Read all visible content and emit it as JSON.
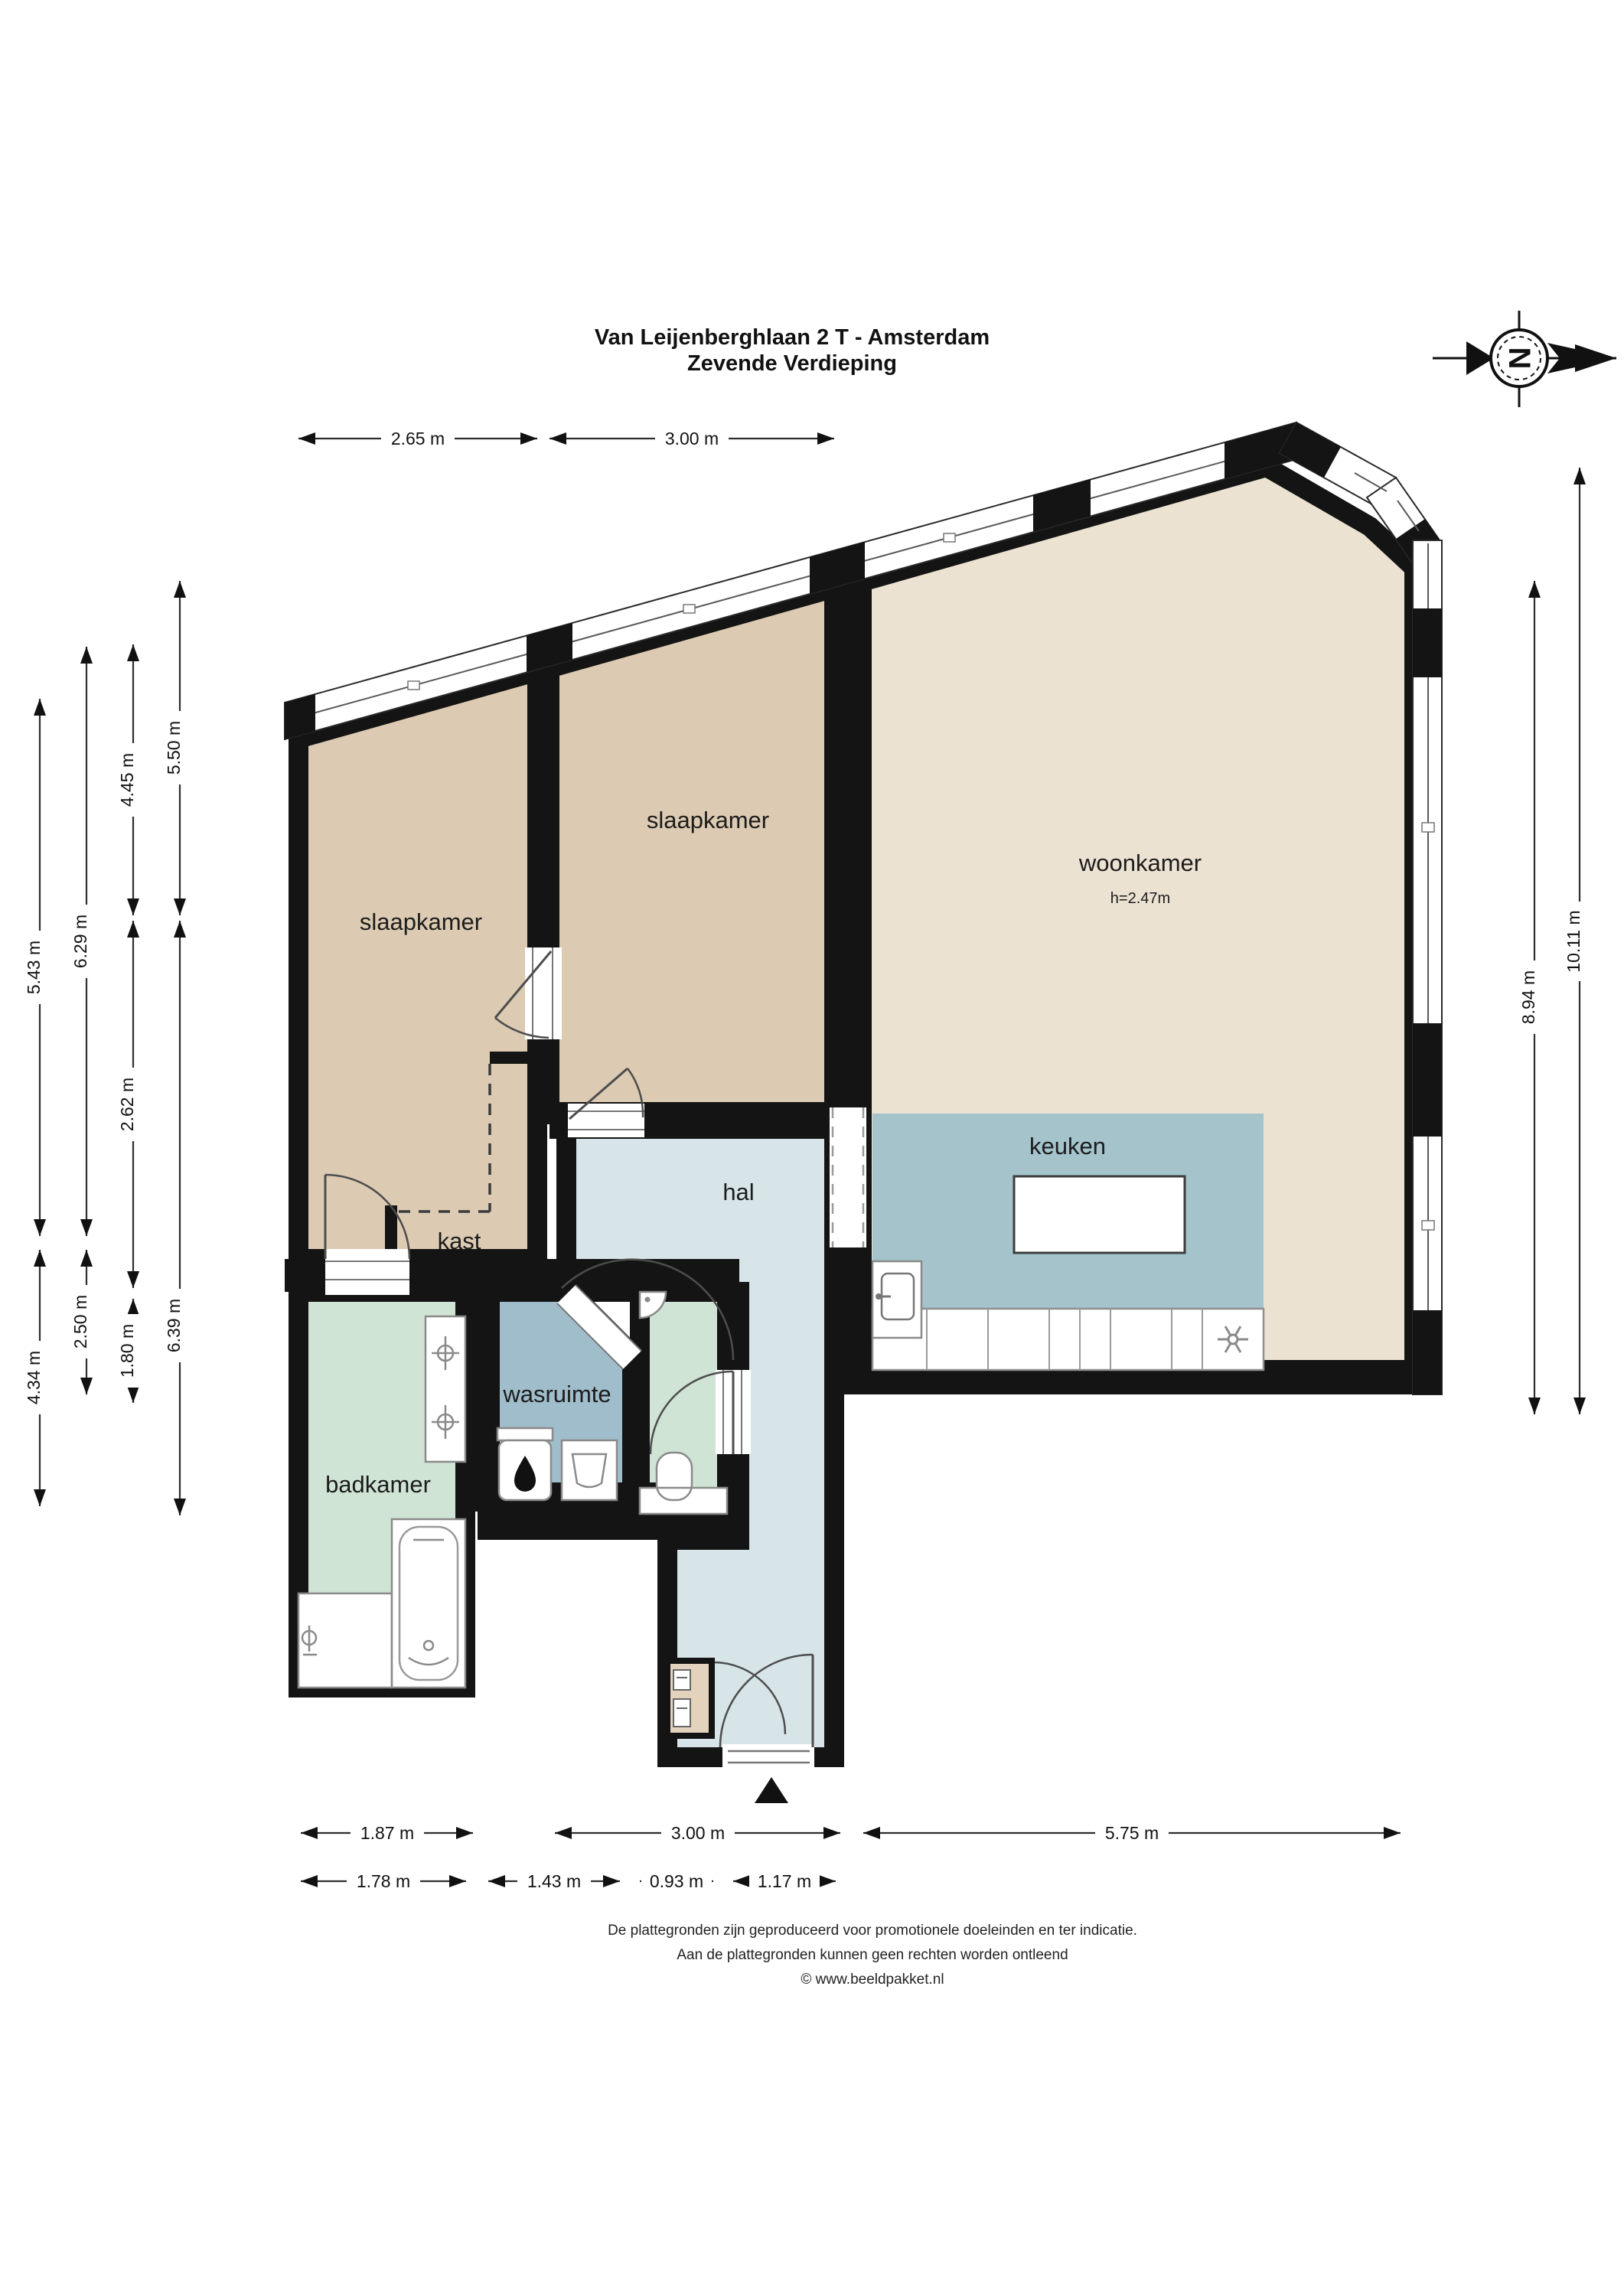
{
  "title": {
    "line1": "Van Leijenberghlaan 2 T - Amsterdam",
    "line2": "Zevende Verdieping"
  },
  "compass": {
    "letter": "N"
  },
  "rooms": [
    {
      "id": "slaapkamer-links",
      "label": "slaapkamer"
    },
    {
      "id": "slaapkamer-midden",
      "label": "slaapkamer"
    },
    {
      "id": "woonkamer",
      "label": "woonkamer",
      "ceiling_height": "h=2.47m"
    },
    {
      "id": "keuken",
      "label": "keuken"
    },
    {
      "id": "hal",
      "label": "hal"
    },
    {
      "id": "kast",
      "label": "kast"
    },
    {
      "id": "wasruimte",
      "label": "wasruimte"
    },
    {
      "id": "badkamer",
      "label": "badkamer"
    }
  ],
  "dimensions": {
    "top": [
      {
        "label": "2.65 m"
      },
      {
        "label": "3.00 m"
      }
    ],
    "left_col1": [
      {
        "label": "5.43 m"
      },
      {
        "label": "4.34 m"
      }
    ],
    "left_col2": [
      {
        "label": "6.29 m"
      },
      {
        "label": "2.50 m"
      }
    ],
    "left_col3": [
      {
        "label": "4.45 m"
      },
      {
        "label": "2.62 m"
      },
      {
        "label": "1.80 m"
      }
    ],
    "left_col4": [
      {
        "label": "5.50 m"
      },
      {
        "label": "6.39 m"
      }
    ],
    "right": [
      {
        "label": "8.94 m"
      },
      {
        "label": "10.11 m"
      }
    ],
    "bottom_row1": [
      {
        "label": "1.87 m"
      },
      {
        "label": "3.00 m"
      },
      {
        "label": "5.75 m"
      }
    ],
    "bottom_row2": [
      {
        "label": "1.78 m"
      },
      {
        "label": "1.43 m"
      },
      {
        "label": "0.93 m"
      },
      {
        "label": "1.17 m"
      }
    ]
  },
  "footer": {
    "line1": "De plattegronden zijn geproduceerd voor promotionele doeleinden en ter indicatie.",
    "line2": "Aan de plattegronden kunnen geen rechten worden ontleend",
    "line3": "© www.beeldpakket.nl"
  },
  "colors": {
    "wall": "#141414",
    "slaapkamer": "#dccbb2",
    "woonkamer": "#ebe2d2",
    "keuken": "#a4c3cb",
    "hal": "#d7e5e9",
    "wasruimte": "#9fbdca",
    "badkamer": "#cfe4d5",
    "meterkast": "#e4d3bc"
  }
}
